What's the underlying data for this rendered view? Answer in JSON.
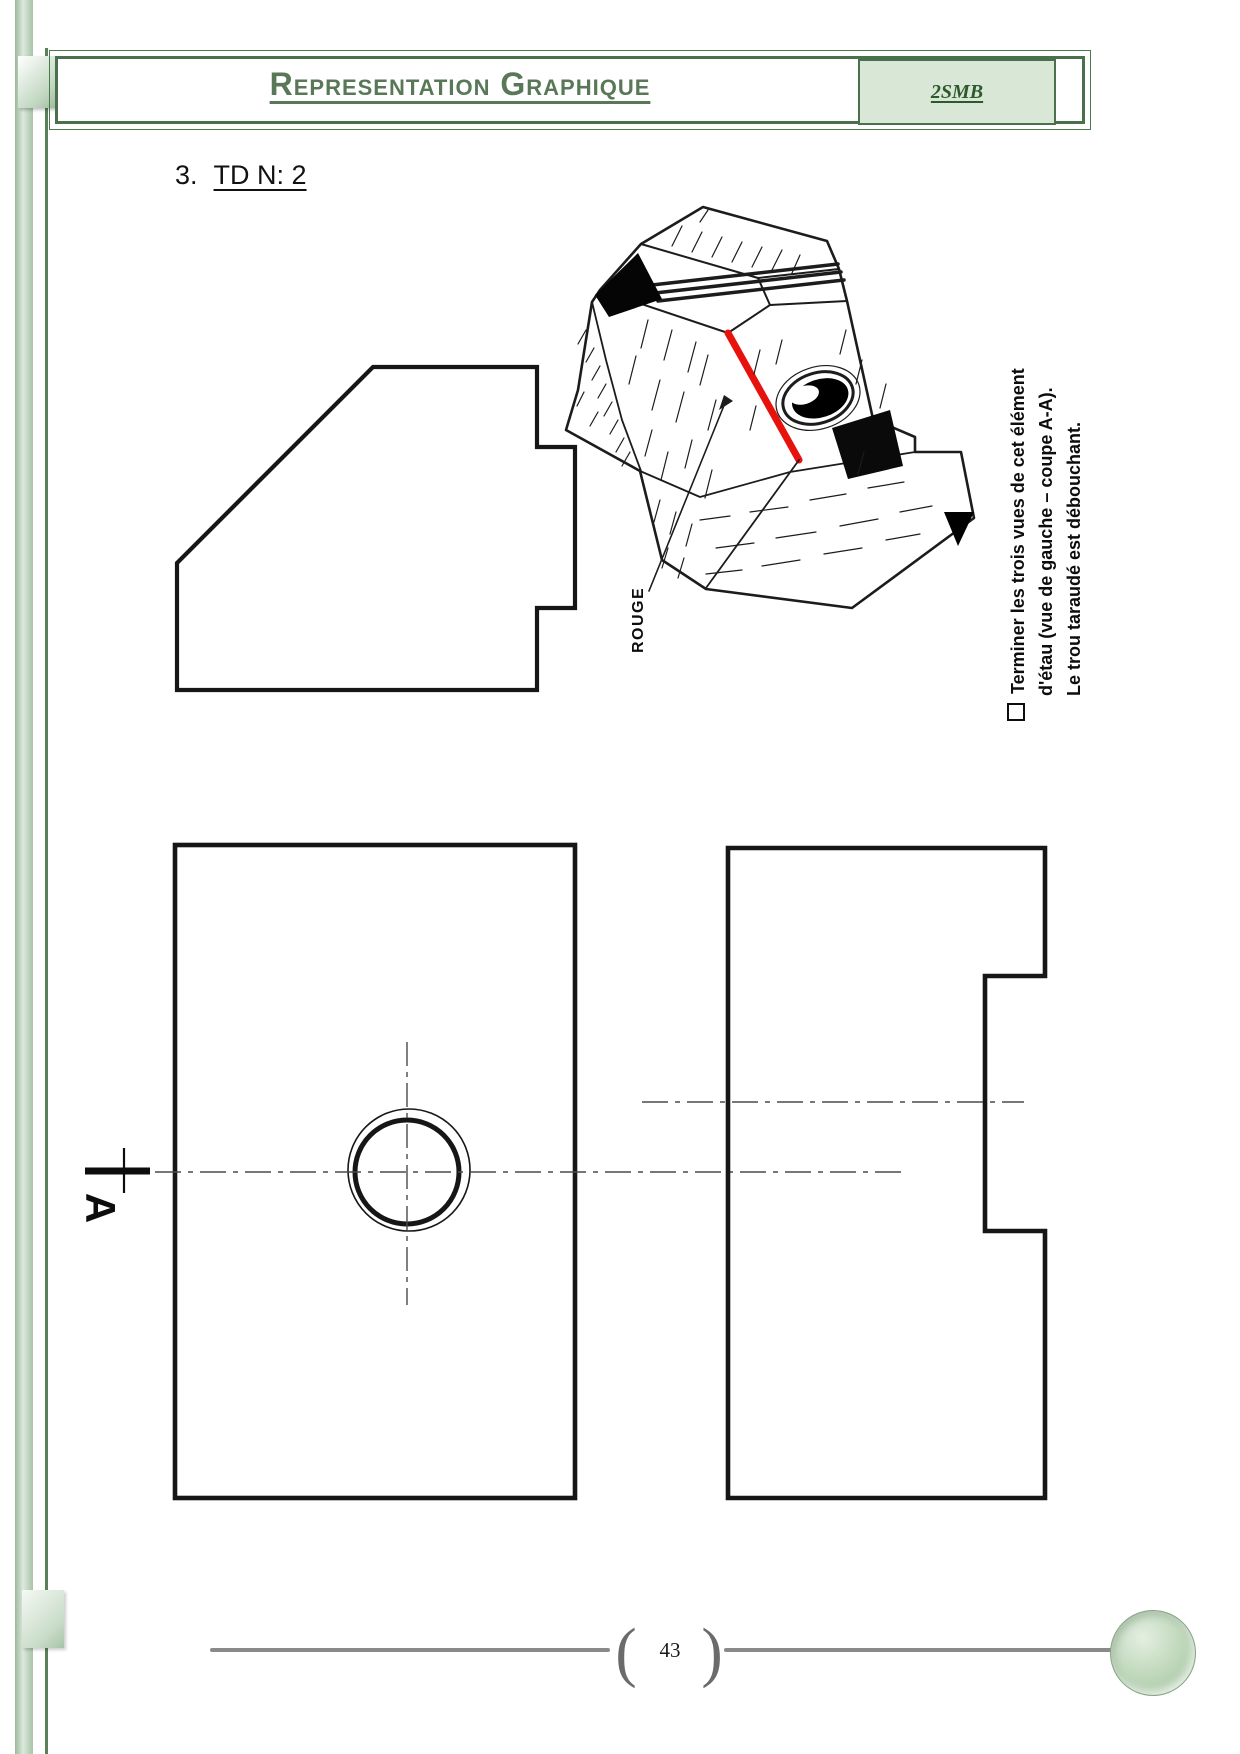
{
  "header": {
    "title": "Representation Graphique",
    "badge": "2SMB"
  },
  "section_heading": {
    "number": "3.",
    "label": "TD N: 2"
  },
  "pictorial": {
    "rouge_label": "ROUGE",
    "instructions": {
      "line1": "Terminer les trois vues de cet élément",
      "line2": "d'étau (vue de gauche – coupe A-A).",
      "line3": "Le trou taraudé est débouchant."
    }
  },
  "views": {
    "section_letter": "A"
  },
  "footer": {
    "page_number": "43",
    "bracket_left": "(",
    "bracket_right": ")"
  },
  "colors": {
    "accent_green": "#49724c",
    "title_green": "#587858",
    "badge_bg": "#d9e7d6",
    "red_line": "#e8120c",
    "drawing_ink": "#161616",
    "footer_gray": "#8a8a8a"
  }
}
